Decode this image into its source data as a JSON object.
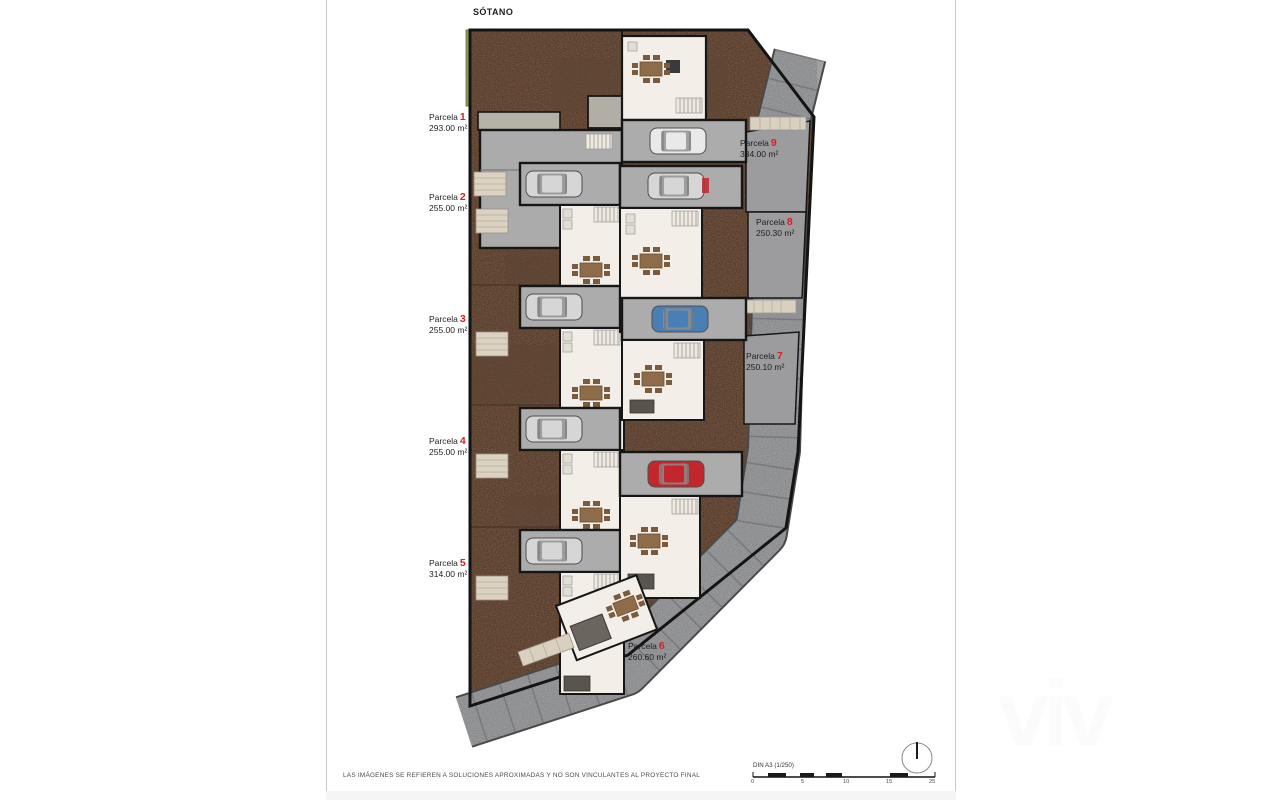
{
  "title": "SÓTANO",
  "disclaimer": "LAS IMÁGENES SE REFIEREN A SOLUCIONES APROXIMADAS Y NO SON VINCULANTES AL PROYECTO FINAL",
  "scale_bar": {
    "label": "DIN A3 (1/250)",
    "ticks": [
      "0",
      "5",
      "10",
      "15",
      "25"
    ]
  },
  "watermark": "viv",
  "parcels": [
    {
      "label": "Parcela",
      "number": "1",
      "area": "293.00 m²"
    },
    {
      "label": "Parcela",
      "number": "2",
      "area": "255.00 m²"
    },
    {
      "label": "Parcela",
      "number": "3",
      "area": "255.00 m²"
    },
    {
      "label": "Parcela",
      "number": "4",
      "area": "255.00 m²"
    },
    {
      "label": "Parcela",
      "number": "5",
      "area": "314.00 m²"
    },
    {
      "label": "Parcela",
      "number": "6",
      "area": "260.60 m²"
    },
    {
      "label": "Parcela",
      "number": "7",
      "area": "250.10 m²"
    },
    {
      "label": "Parcela",
      "number": "8",
      "area": "250.30 m²"
    },
    {
      "label": "Parcela",
      "number": "9",
      "area": "334.00 m²"
    }
  ],
  "colors": {
    "terrain": "#7c5a44",
    "street": "#a0a1a3",
    "building_floor": "#f3efe8",
    "garage_floor": "#acacac",
    "wall": "#161616",
    "parcel_number_red": "#d42027",
    "grass_strip": "#8e9c59",
    "car_blue": "#4a7fb5",
    "car_red": "#c1272d"
  }
}
